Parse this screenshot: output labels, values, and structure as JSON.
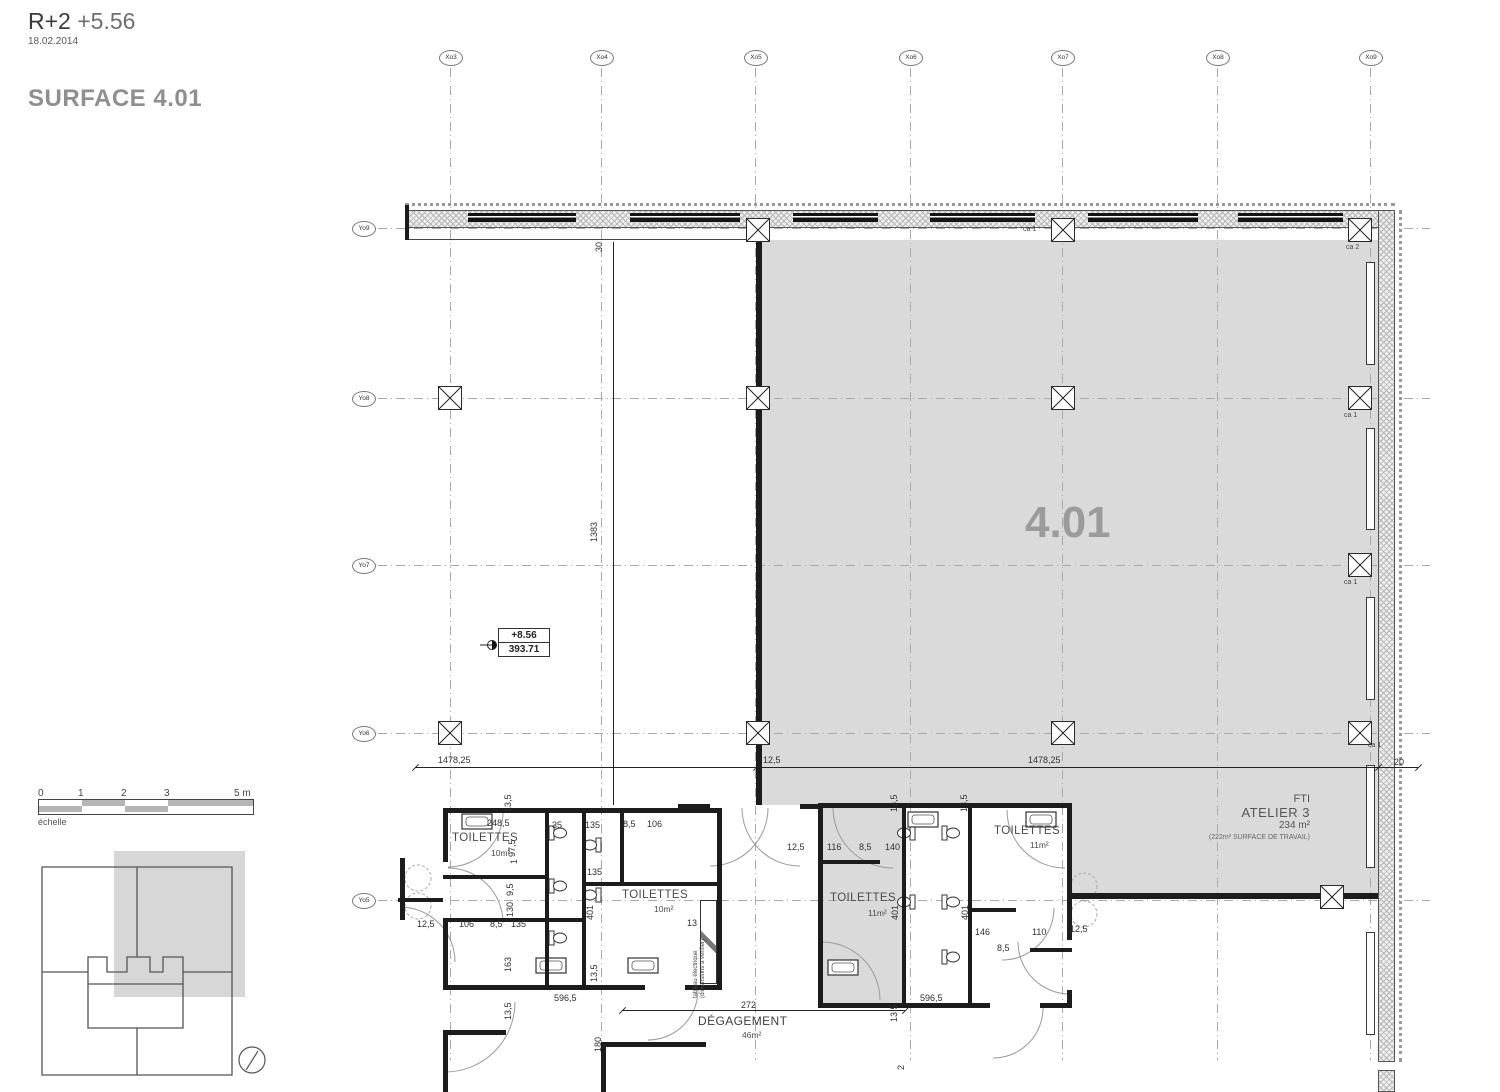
{
  "title": {
    "level": "R+2",
    "elev": "+5.56",
    "date": "18.02.2014",
    "surface": "SURFACE 4.01"
  },
  "big_room": {
    "number": "4.01"
  },
  "fti": {
    "l1": "FTI",
    "l2": "ATELIER 3",
    "l3": "234 m²",
    "l4": "(222m² SURFACE DE TRAVAIL)"
  },
  "level_marker": {
    "top": "+8.56",
    "bottom": "393.71"
  },
  "corridor": {
    "name": "DÉGAGEMENT",
    "area": "46m²"
  },
  "electrical_note": {
    "l1": "tableau électrique",
    "l2": "(dimensions à vérifier)"
  },
  "scalebar": {
    "caption": "échelle",
    "ticks": [
      {
        "t": "0",
        "x": 0
      },
      {
        "t": "1",
        "x": 40
      },
      {
        "t": "2",
        "x": 83
      },
      {
        "t": "3",
        "x": 126
      },
      {
        "t": "5 m",
        "x": 196
      }
    ]
  },
  "grid": {
    "x_axes": [
      {
        "label": "Xo3",
        "x": 450
      },
      {
        "label": "Xo4",
        "x": 601
      },
      {
        "label": "Xo5",
        "x": 755
      },
      {
        "label": "Xo6",
        "x": 910
      },
      {
        "label": "Xo7",
        "x": 1062
      },
      {
        "label": "Xo8",
        "x": 1217
      },
      {
        "label": "Xo9",
        "x": 1370
      }
    ],
    "y_axes": [
      {
        "label": "Yo9",
        "y": 228
      },
      {
        "label": "Yo8",
        "y": 398
      },
      {
        "label": "Yo7",
        "y": 565
      },
      {
        "label": "Yo6",
        "y": 733
      },
      {
        "label": "Yo5",
        "y": 900
      }
    ]
  },
  "columns": [
    {
      "x": 450,
      "y": 398
    },
    {
      "x": 450,
      "y": 733
    },
    {
      "x": 758,
      "y": 230
    },
    {
      "x": 758,
      "y": 398
    },
    {
      "x": 758,
      "y": 733
    },
    {
      "x": 1063,
      "y": 230,
      "tag": "ca 1",
      "tx": -40,
      "ty": -4
    },
    {
      "x": 1063,
      "y": 398
    },
    {
      "x": 1063,
      "y": 733
    },
    {
      "x": 1360,
      "y": 230,
      "tag": "ca 2",
      "tx": -14,
      "ty": 14
    },
    {
      "x": 1360,
      "y": 398,
      "tag": "ca 1",
      "tx": -16,
      "ty": 14
    },
    {
      "x": 1360,
      "y": 565,
      "tag": "ca 1",
      "tx": -16,
      "ty": 14
    },
    {
      "x": 1360,
      "y": 733,
      "tag": "ca 1",
      "tx": 8,
      "ty": 9
    },
    {
      "x": 1332,
      "y": 897
    }
  ],
  "windows_top": [
    {
      "x": 468,
      "w": 108
    },
    {
      "x": 630,
      "w": 110
    },
    {
      "x": 793,
      "w": 85
    },
    {
      "x": 930,
      "w": 105
    },
    {
      "x": 1088,
      "w": 110
    },
    {
      "x": 1238,
      "w": 105
    }
  ],
  "windows_right": [
    {
      "y": 262,
      "h": 103
    },
    {
      "y": 428,
      "h": 102
    },
    {
      "y": 597,
      "h": 103
    },
    {
      "y": 765,
      "h": 103
    },
    {
      "y": 932,
      "h": 103
    }
  ],
  "room_labels": [
    {
      "t": "TOILETTES",
      "x": 452,
      "y": 832,
      "big": 1
    },
    {
      "t": "10m²",
      "x": 491,
      "y": 848
    },
    {
      "t": "TOILETTES",
      "x": 622,
      "y": 889,
      "big": 1
    },
    {
      "t": "10m²",
      "x": 654,
      "y": 904
    },
    {
      "t": "TOILETTES",
      "x": 830,
      "y": 892,
      "big": 1
    },
    {
      "t": "11m²",
      "x": 868,
      "y": 908
    },
    {
      "t": "TOILETTES",
      "x": 994,
      "y": 825,
      "big": 1
    },
    {
      "t": "11m²",
      "x": 1030,
      "y": 840
    }
  ],
  "dimensions": [
    {
      "t": "1478,25",
      "x": 438,
      "y": 755
    },
    {
      "t": "12,5",
      "x": 763,
      "y": 755
    },
    {
      "t": "1478,25",
      "x": 1028,
      "y": 755
    },
    {
      "t": "20",
      "x": 1394,
      "y": 757
    },
    {
      "t": "30",
      "x": 604,
      "y": 242,
      "v": 1
    },
    {
      "t": "1383",
      "x": 599,
      "y": 532,
      "v": 1
    },
    {
      "t": "13,5",
      "x": 513,
      "y": 802,
      "v": 1
    },
    {
      "t": "248,5",
      "x": 487,
      "y": 818
    },
    {
      "t": "97,5",
      "x": 517,
      "y": 847,
      "v": 1
    },
    {
      "t": "35",
      "x": 552,
      "y": 820
    },
    {
      "t": "135",
      "x": 585,
      "y": 820
    },
    {
      "t": "8,5",
      "x": 623,
      "y": 819
    },
    {
      "t": "106",
      "x": 647,
      "y": 819
    },
    {
      "t": "135",
      "x": 587,
      "y": 867
    },
    {
      "t": "9,5",
      "x": 515,
      "y": 886,
      "v": 1
    },
    {
      "t": "130",
      "x": 515,
      "y": 907,
      "v": 1
    },
    {
      "t": "1",
      "x": 519,
      "y": 854,
      "v": 1
    },
    {
      "t": "401",
      "x": 595,
      "y": 910,
      "v": 1
    },
    {
      "t": "12,5",
      "x": 417,
      "y": 919
    },
    {
      "t": "106",
      "x": 459,
      "y": 919
    },
    {
      "t": "8,5",
      "x": 490,
      "y": 919
    },
    {
      "t": "135",
      "x": 511,
      "y": 919
    },
    {
      "t": "163",
      "x": 513,
      "y": 962,
      "v": 1
    },
    {
      "t": "13,5",
      "x": 599,
      "y": 972,
      "v": 1
    },
    {
      "t": "13,5",
      "x": 513,
      "y": 1010,
      "v": 1
    },
    {
      "t": "596,5",
      "x": 554,
      "y": 993
    },
    {
      "t": "12,5",
      "x": 787,
      "y": 842
    },
    {
      "t": "116",
      "x": 827,
      "y": 842
    },
    {
      "t": "8,5",
      "x": 859,
      "y": 842
    },
    {
      "t": "140",
      "x": 885,
      "y": 842
    },
    {
      "t": "13,5",
      "x": 899,
      "y": 802,
      "v": 1
    },
    {
      "t": "13,5",
      "x": 969,
      "y": 802,
      "v": 1
    },
    {
      "t": "401",
      "x": 900,
      "y": 910,
      "v": 1
    },
    {
      "t": "401",
      "x": 970,
      "y": 910,
      "v": 1
    },
    {
      "t": "146",
      "x": 975,
      "y": 927
    },
    {
      "t": "8,5",
      "x": 997,
      "y": 943
    },
    {
      "t": "110",
      "x": 1032,
      "y": 927
    },
    {
      "t": "12,5",
      "x": 1070,
      "y": 924
    },
    {
      "t": "13,5",
      "x": 899,
      "y": 1012,
      "v": 1
    },
    {
      "t": "596,5",
      "x": 920,
      "y": 993
    },
    {
      "t": "272",
      "x": 741,
      "y": 1000
    },
    {
      "t": "180",
      "x": 603,
      "y": 1042,
      "v": 1
    },
    {
      "t": "13",
      "x": 687,
      "y": 918
    },
    {
      "t": "2",
      "x": 906,
      "y": 1060,
      "v": 1
    }
  ]
}
